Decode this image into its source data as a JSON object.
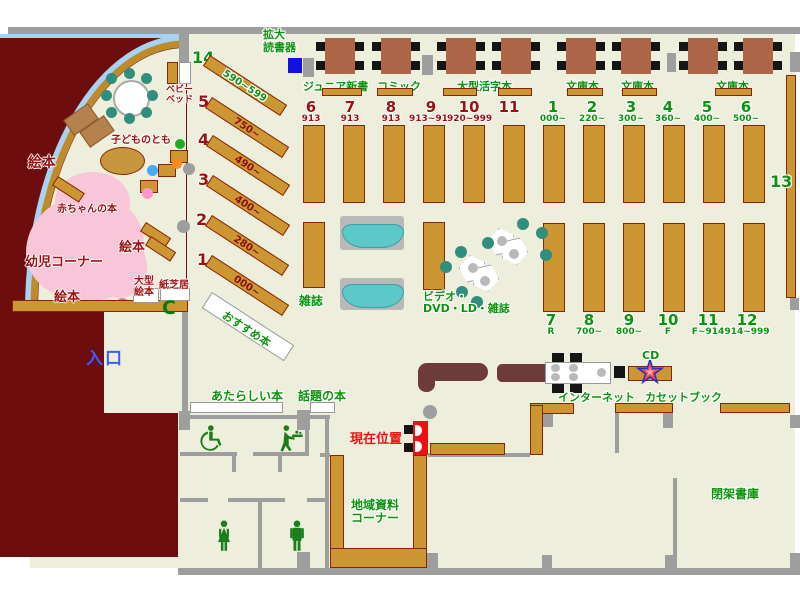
{
  "colors": {
    "floor": "#edeedb",
    "wall": "#9e9e9e",
    "shelf_brown": "#cc9733",
    "kids_block_maroon": "#6d0d0d",
    "infant_pink": "#f9c5d9",
    "green_text": "#0b940b",
    "dark_red_text": "#9b1111",
    "entrance_blue": "#3a5bff",
    "marker_red": "#ee1111",
    "bench_teal": "#5cc8c8",
    "chair_teal": "#2f8e7e",
    "reader_blue": "#1111dd",
    "counter_maroon": "#6e3c38",
    "arc_blue": "#a8d2f2"
  },
  "labels": {
    "magnifier_l1": "拡大",
    "magnifier_l2": "読書器",
    "junior": "ジュニア新書",
    "comic": "コミック",
    "large_print": "大型活字本",
    "bunko1": "文庫本",
    "bunko2": "文庫本",
    "bunko3": "文庫本",
    "magazine": "雑誌",
    "video_l1": "ビデオ・",
    "video_l2": "DVD・LD・雑誌",
    "cd": "CD",
    "internet": "インターネット",
    "cassette": "カセットブック",
    "entrance": "入口",
    "current_location": "現在位置",
    "new_books": "あたらしい本",
    "topic_books": "話題の本",
    "recommend": "おすすめ本",
    "local_l1": "地域資料",
    "local_l2": "コーナー",
    "closed_stacks": "閉架書庫",
    "shelf13": "13"
  },
  "kids": {
    "ehon_big": "絵本",
    "ehon_mid": "絵本",
    "ehon_low": "絵本",
    "baby_books": "赤ちゃんの本",
    "infant": "幼児コーナー",
    "kodomo": "子どものとも",
    "bed_l1": "ベビー",
    "bed_l2": "ベッド",
    "ogata_l1": "大型",
    "ogata_l2": "絵本",
    "kamishibai": "紙芝居"
  },
  "diagonal_shelves": [
    {
      "no": "14",
      "range": "590~599"
    },
    {
      "no": "5",
      "range": "750~"
    },
    {
      "no": "4",
      "range": "490~"
    },
    {
      "no": "3",
      "range": "400~"
    },
    {
      "no": "2",
      "range": "280~"
    },
    {
      "no": "1",
      "range": "000~"
    }
  ],
  "top_shelves": [
    {
      "no": "6",
      "range": "913"
    },
    {
      "no": "7",
      "range": "913"
    },
    {
      "no": "8",
      "range": "913"
    },
    {
      "no": "9",
      "range": "913~919"
    },
    {
      "no": "10",
      "range": "920~999"
    },
    {
      "no": "11",
      "range": ""
    }
  ],
  "right_top_shelves": [
    {
      "no": "1",
      "range": "000~"
    },
    {
      "no": "2",
      "range": "220~"
    },
    {
      "no": "3",
      "range": "300~"
    },
    {
      "no": "4",
      "range": "360~"
    },
    {
      "no": "5",
      "range": "400~"
    },
    {
      "no": "6",
      "range": "500~"
    }
  ],
  "right_bottom_shelves": [
    {
      "no": "7",
      "range": "R"
    },
    {
      "no": "8",
      "range": "700~"
    },
    {
      "no": "9",
      "range": "800~"
    },
    {
      "no": "10",
      "range": "F"
    },
    {
      "no": "11",
      "range": "F~914"
    },
    {
      "no": "12",
      "range": "914~999"
    }
  ]
}
